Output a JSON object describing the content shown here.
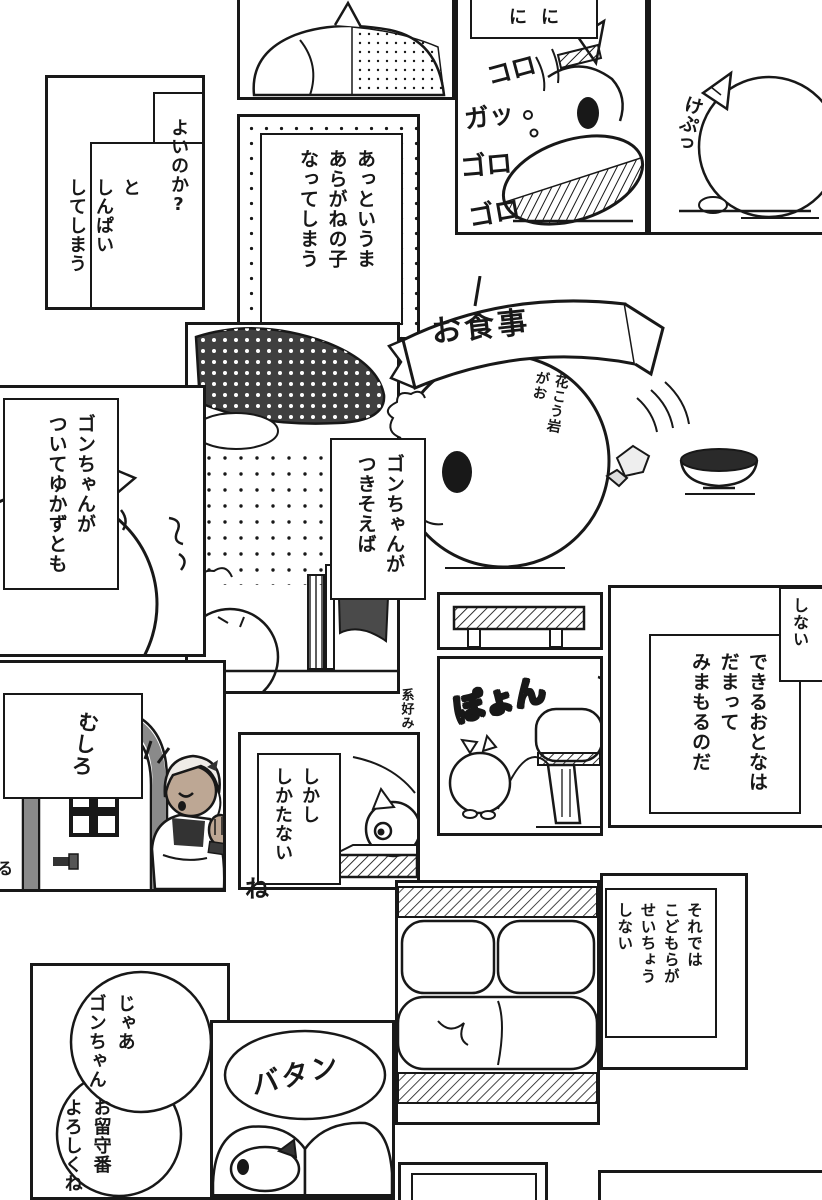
{
  "page": {
    "kind": "manga-page",
    "reading_direction": "right-to-left",
    "colors": {
      "paper": "#ffffff",
      "ink": "#181818",
      "tone_dark": "#3f3f3f",
      "tone_mid": "#8a8a8a",
      "skin": "#bda794",
      "hair": "#efece8"
    }
  },
  "texts": {
    "worry_head": "よいのか?",
    "worry_body": "と\nしんぱい\nしてしまう",
    "transform": "あっというま\nあらがねの子\nなってしまう",
    "bubble_top": "にに",
    "sfx_koro": "コロ",
    "sfx_ga": "ガッ",
    "sfx_goro1": "ゴロ",
    "sfx_goro2": "ゴロ",
    "sfx_kepu": "けぷっ",
    "banner_meal": "お食事",
    "note_granite": "花こう岩\nがお",
    "note_preference": "系好み",
    "follow": "ゴンちゃんが\nついてゆかずとも",
    "accompany": "ゴンちゃんが\nつきそえば",
    "fragment_shinai": "しない",
    "adults": "できるおとなは\nだまって\nみまもるのだ",
    "mushiro": "むしろ",
    "sfx_ru": "る",
    "resign": "しかし\nしかたない",
    "particle_ne": "ね",
    "sfx_boyon": "ぽょん",
    "grow": "それでは\nこどもらが\nせいちょう\nしない",
    "farewell_head": "じゃあ\nゴンちゃん",
    "farewell_body": "お留守番\nよろしくね",
    "sfx_batan": "バタン"
  }
}
